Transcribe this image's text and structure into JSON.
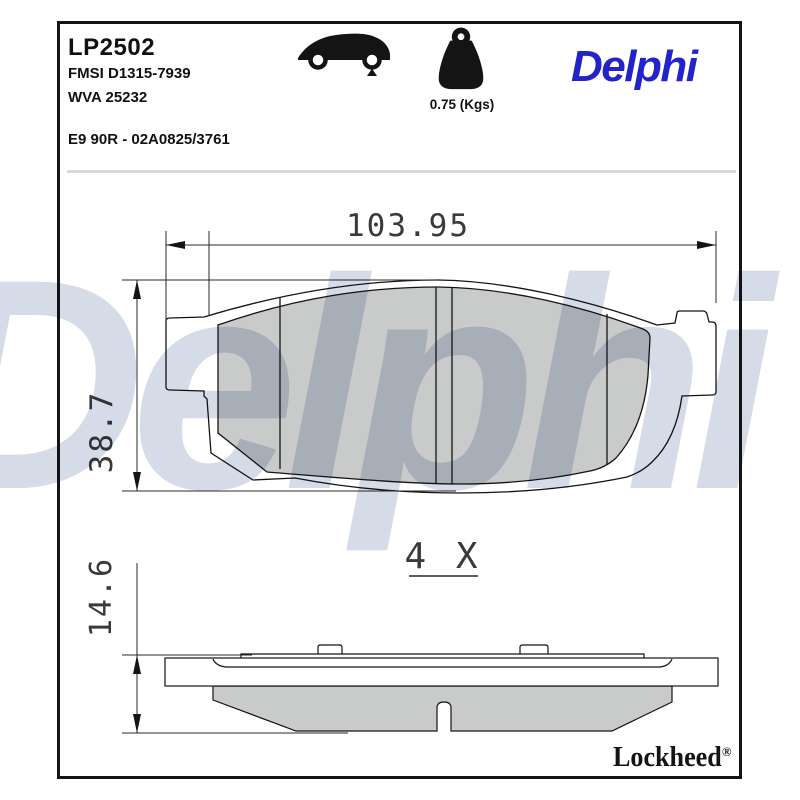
{
  "header": {
    "part_number": "LP2502",
    "fmsi_ref": "FMSI D1315-7939",
    "wva_ref": "WVA 25232",
    "approval_ref": "E9 90R - 02A0825/3761",
    "weight_value": "0.75 (Kgs)",
    "brand_logo": "Delphi",
    "icons": {
      "vehicle": "car-rear-axle-icon",
      "mass": "weight-icon"
    }
  },
  "drawing": {
    "front_view": {
      "width_mm": "103.95",
      "height_mm": "38.7",
      "quantity_note": "4 X"
    },
    "side_view": {
      "thickness_mm": "14.6"
    }
  },
  "watermark": "Delphi",
  "footer": {
    "brand": "Lockheed",
    "registered_mark": "®"
  },
  "colors": {
    "brand_blue": "#2323CC",
    "friction_gray": "#C9CACA",
    "watermark_blue": "#D5DCE8",
    "line_black": "#141414",
    "separator_gray": "#D8D8D8"
  }
}
